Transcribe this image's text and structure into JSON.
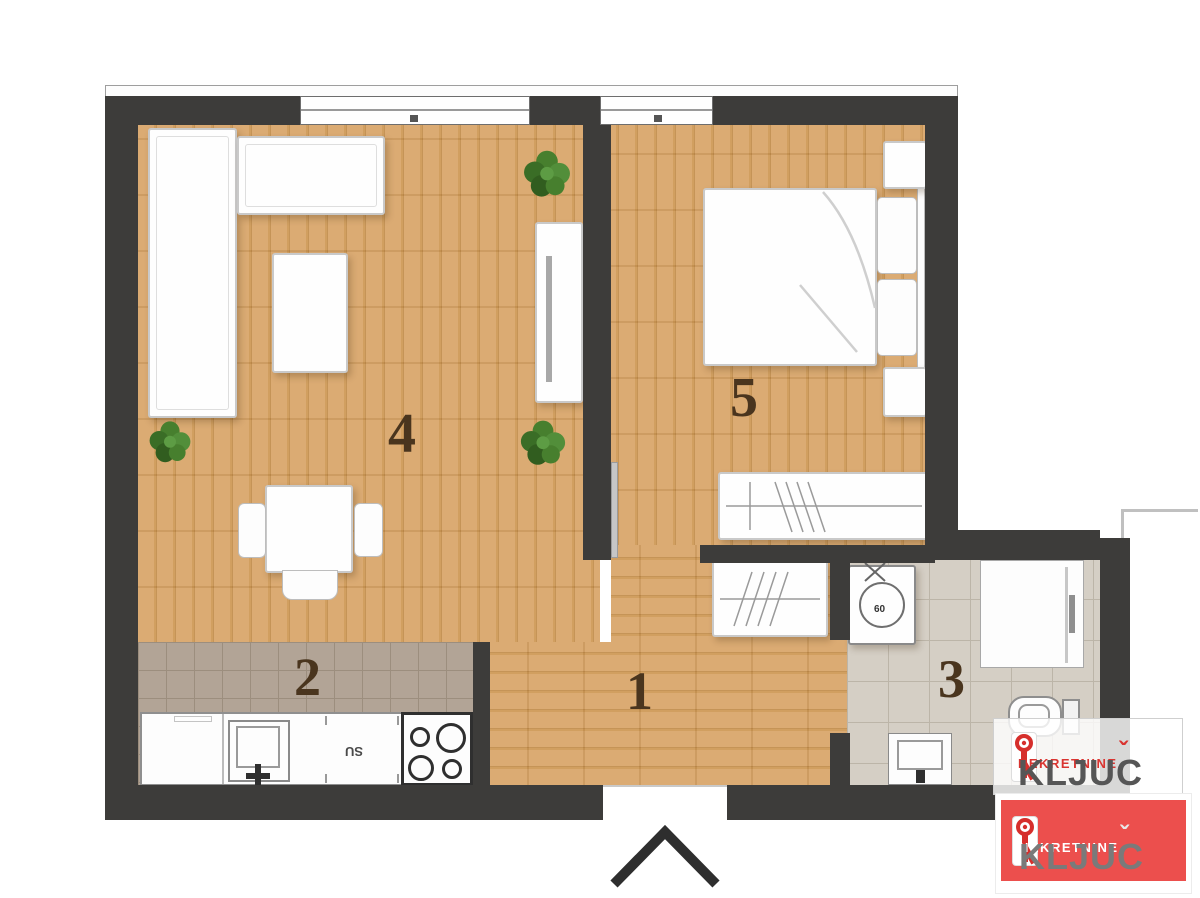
{
  "rooms": {
    "hallway": {
      "label": "1"
    },
    "kitchen": {
      "label": "2"
    },
    "bathroom": {
      "label": "3"
    },
    "living": {
      "label": "4"
    },
    "bedroom": {
      "label": "5"
    }
  },
  "kitchen": {
    "unit_label": "SU"
  },
  "bathroom": {
    "washer_label": "60"
  },
  "branding": {
    "watermark": {
      "top_text": "NEKRETNINE",
      "main_base": "KLJU",
      "main_c": "C",
      "caron": "ˇ"
    },
    "logo": {
      "top_text": "NEKRETNINE",
      "main_base": "KLJU",
      "main_c": "C",
      "caron": "ˇ"
    }
  },
  "icons": {
    "entrance_arrow": "chevron-up",
    "brand_key": "key",
    "plants": "potted-plant"
  },
  "colors": {
    "wall": "#3d3c3a",
    "wood": "#d9a76c",
    "wood_line": "#c28e4e",
    "kitchen_tile": "#b2a496",
    "bath_tile": "#d5cfc5",
    "brand_red": "#e0403c",
    "logo_box_red": "#ec4f4d",
    "label_brown": "#4a351e"
  }
}
